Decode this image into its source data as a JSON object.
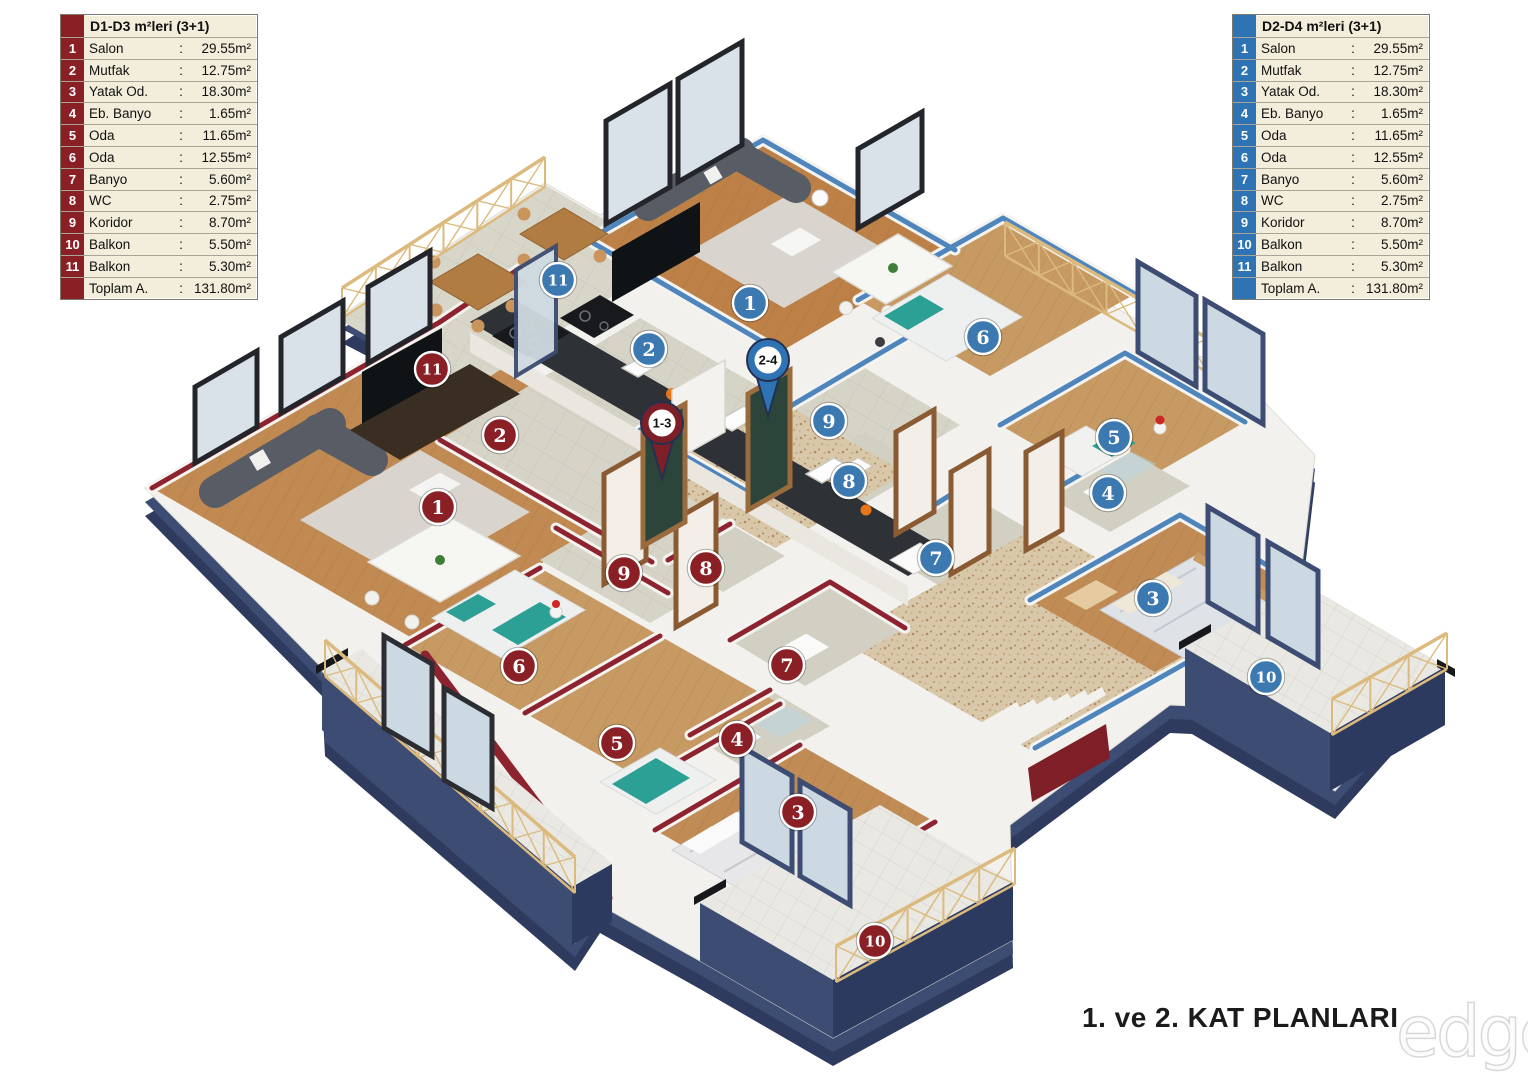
{
  "meta": {
    "title": "1. ve 2. KAT PLANLARI",
    "watermark": "edge"
  },
  "legend_left": {
    "header": "D1-D3 m²leri (3+1)",
    "accent": "#8a2026",
    "rows": [
      {
        "num": "1",
        "name": "Salon",
        "value": "29.55m²"
      },
      {
        "num": "2",
        "name": "Mutfak",
        "value": "12.75m²"
      },
      {
        "num": "3",
        "name": "Yatak Od.",
        "value": "18.30m²"
      },
      {
        "num": "4",
        "name": "Eb. Banyo",
        "value": "1.65m²"
      },
      {
        "num": "5",
        "name": "Oda",
        "value": "11.65m²"
      },
      {
        "num": "6",
        "name": "Oda",
        "value": "12.55m²"
      },
      {
        "num": "7",
        "name": "Banyo",
        "value": "5.60m²"
      },
      {
        "num": "8",
        "name": "WC",
        "value": "2.75m²"
      },
      {
        "num": "9",
        "name": "Koridor",
        "value": "8.70m²"
      },
      {
        "num": "10",
        "name": "Balkon",
        "value": "5.50m²"
      },
      {
        "num": "11",
        "name": "Balkon",
        "value": "5.30m²"
      }
    ],
    "total_name": "Toplam A.",
    "total_value": "131.80m²"
  },
  "legend_right": {
    "header": "D2-D4 m²leri (3+1)",
    "accent": "#2e74b5",
    "rows": [
      {
        "num": "1",
        "name": "Salon",
        "value": "29.55m²"
      },
      {
        "num": "2",
        "name": "Mutfak",
        "value": "12.75m²"
      },
      {
        "num": "3",
        "name": "Yatak Od.",
        "value": "18.30m²"
      },
      {
        "num": "4",
        "name": "Eb. Banyo",
        "value": "1.65m²"
      },
      {
        "num": "5",
        "name": "Oda",
        "value": "11.65m²"
      },
      {
        "num": "6",
        "name": "Oda",
        "value": "12.55m²"
      },
      {
        "num": "7",
        "name": "Banyo",
        "value": "5.60m²"
      },
      {
        "num": "8",
        "name": "WC",
        "value": "2.75m²"
      },
      {
        "num": "9",
        "name": "Koridor",
        "value": "8.70m²"
      },
      {
        "num": "10",
        "name": "Balkon",
        "value": "5.50m²"
      },
      {
        "num": "11",
        "name": "Balkon",
        "value": "5.30m²"
      }
    ],
    "total_name": "Toplam A.",
    "total_value": "131.80m²"
  },
  "plan": {
    "pins": [
      {
        "label": "1-3",
        "x": 662,
        "y": 423,
        "color": "#7e1f28"
      },
      {
        "label": "2-4",
        "x": 768,
        "y": 360,
        "color": "#2e74b5"
      }
    ],
    "markers_d1": [
      {
        "label": "1",
        "x": 438,
        "y": 507
      },
      {
        "label": "2",
        "x": 500,
        "y": 435
      },
      {
        "label": "3",
        "x": 798,
        "y": 812
      },
      {
        "label": "4",
        "x": 737,
        "y": 739
      },
      {
        "label": "5",
        "x": 617,
        "y": 743
      },
      {
        "label": "6",
        "x": 519,
        "y": 666
      },
      {
        "label": "7",
        "x": 787,
        "y": 665
      },
      {
        "label": "8",
        "x": 706,
        "y": 568
      },
      {
        "label": "9",
        "x": 624,
        "y": 573
      },
      {
        "label": "10",
        "x": 875,
        "y": 941
      },
      {
        "label": "11",
        "x": 432,
        "y": 369
      }
    ],
    "markers_d2": [
      {
        "label": "1",
        "x": 750,
        "y": 303
      },
      {
        "label": "2",
        "x": 649,
        "y": 349
      },
      {
        "label": "3",
        "x": 1153,
        "y": 598
      },
      {
        "label": "4",
        "x": 1108,
        "y": 493
      },
      {
        "label": "5",
        "x": 1114,
        "y": 437
      },
      {
        "label": "6",
        "x": 983,
        "y": 337
      },
      {
        "label": "7",
        "x": 936,
        "y": 558
      },
      {
        "label": "8",
        "x": 849,
        "y": 481
      },
      {
        "label": "9",
        "x": 829,
        "y": 421
      },
      {
        "label": "10",
        "x": 1266,
        "y": 677
      },
      {
        "label": "11",
        "x": 558,
        "y": 280
      }
    ],
    "marker_color_d1": "#8a2026",
    "marker_color_d2": "#3c79b0"
  },
  "colors": {
    "wall_cap_d1": "#8e2330",
    "wall_cap_d2": "#4e85bd",
    "exterior_navy": "#3d4c72",
    "railing_gold": "#dcba7e"
  }
}
